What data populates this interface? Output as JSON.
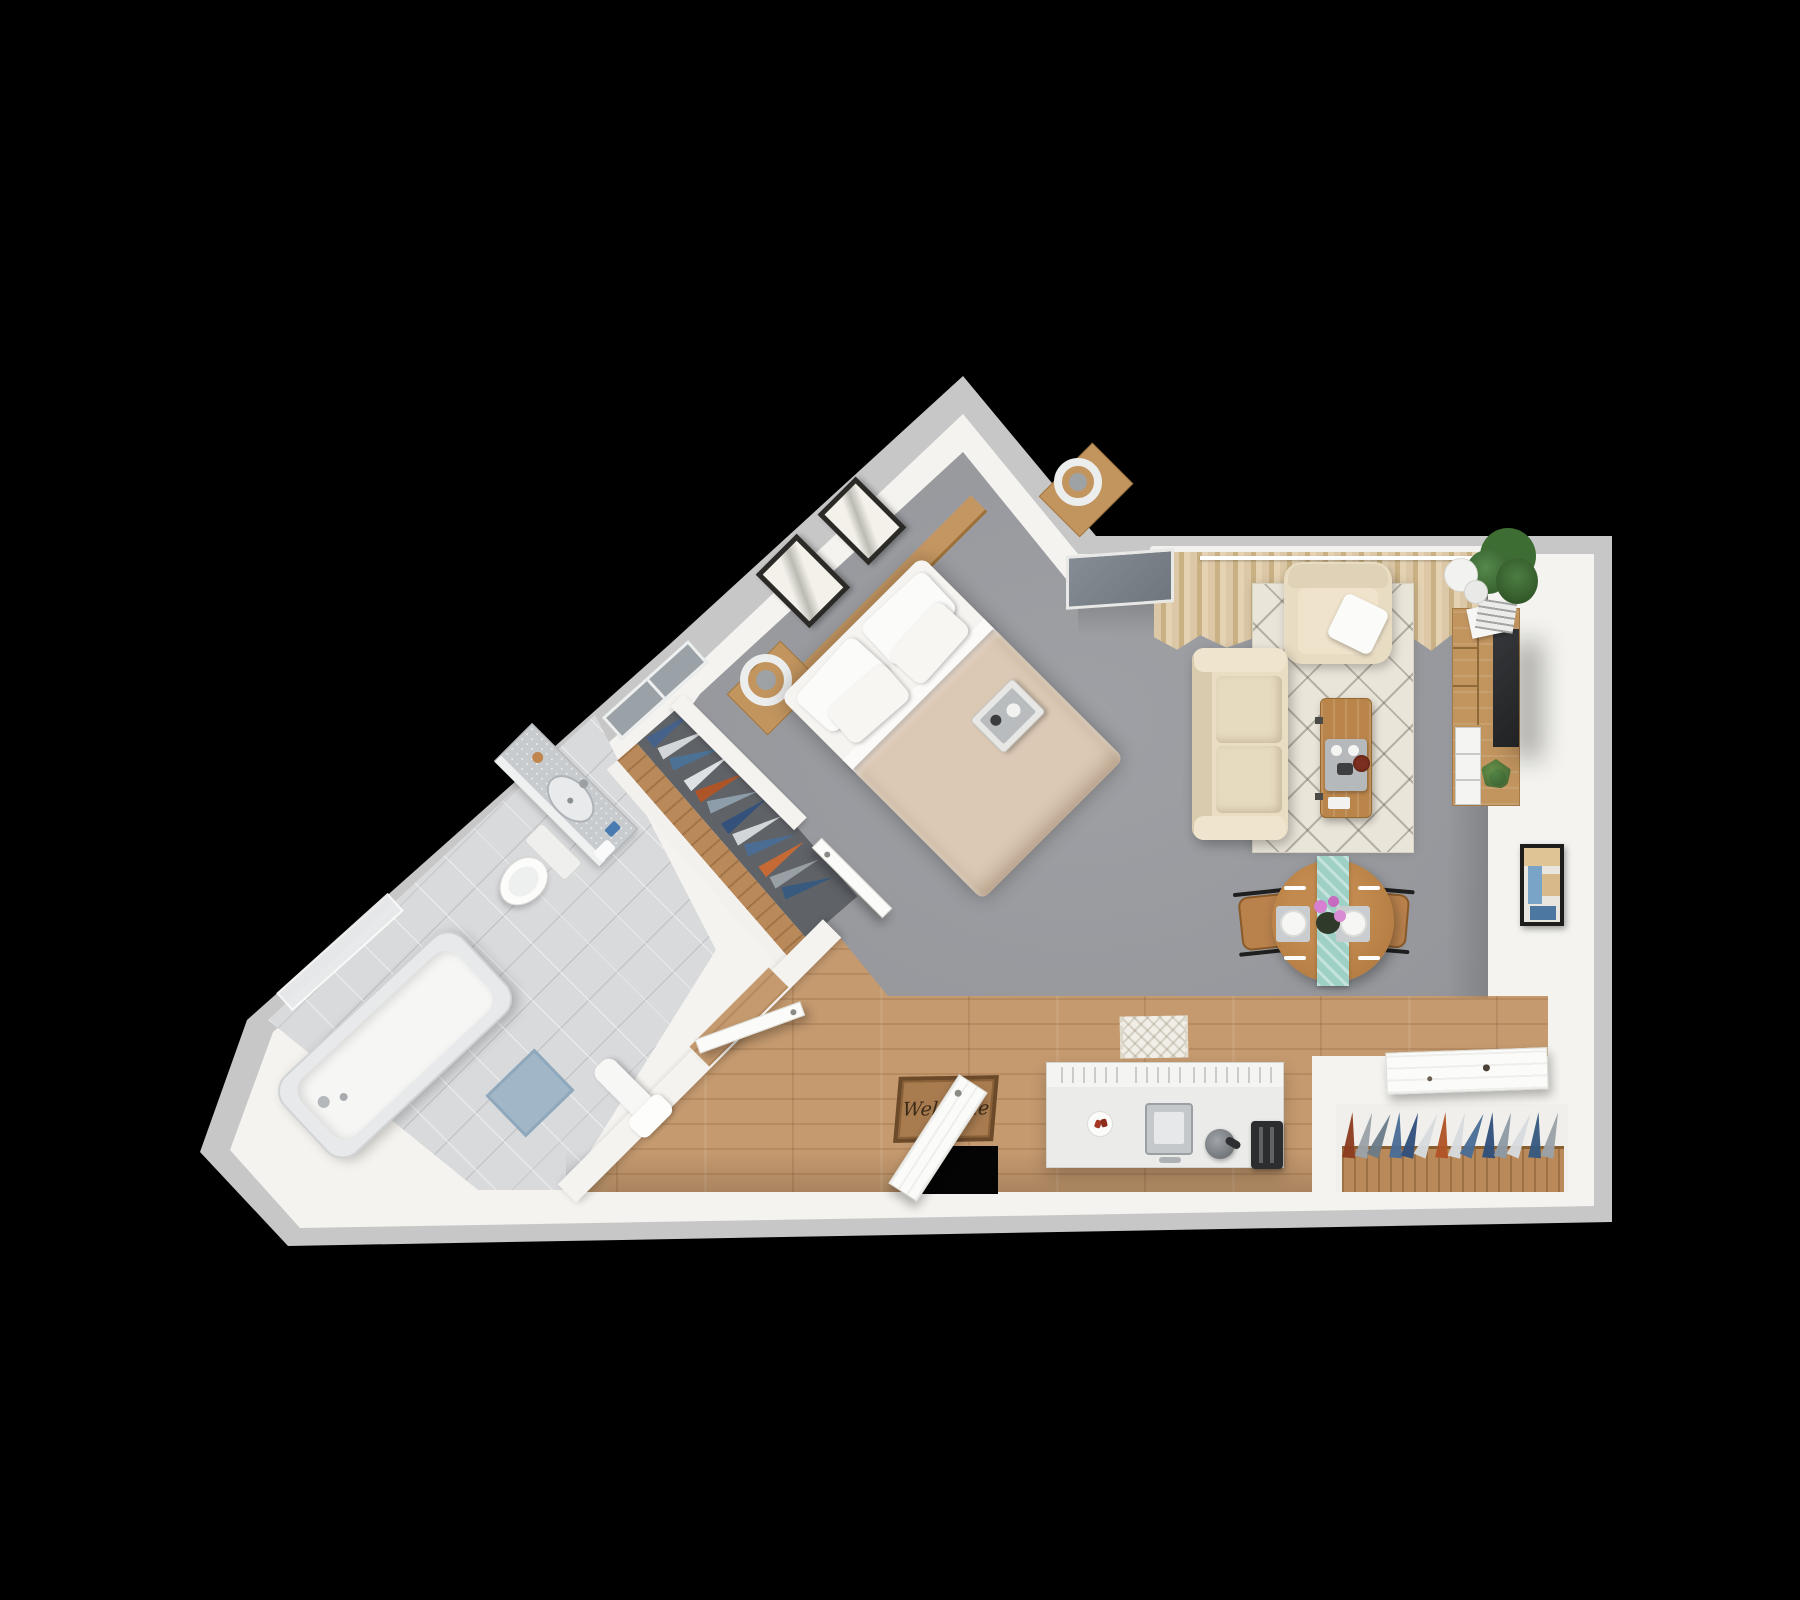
{
  "scene": {
    "description": "3D top-down rendered floor plan of a studio apartment on a black background",
    "width": 1800,
    "height": 1600
  },
  "texts": {
    "doormat": "Welcome"
  },
  "palette": {
    "background": "#000000",
    "wall_outer": "#c7c7c7",
    "wall_inner": "#f4f3ef",
    "carpet": "#96989d",
    "wardrobe_floor_shadow": "#5f6368",
    "wood_floor": "#c59a6f",
    "wood_furniture": "#c2955f",
    "bathroom_tile": "#d9dadc",
    "area_rug_cream": "#eae5d9",
    "sofa_beige": "#e9ddc4",
    "bed_duvet": "#dcc9b5",
    "table_runner_teal": "#9fd0c6",
    "doormat_brown": "#a97c50",
    "plant_green": "#4a7a3d",
    "tv_screen": "#2a2b2d",
    "skylight_gray": "#7f868e",
    "bath_mat_blue": "#9fb6c7",
    "flower_pink": "#d77fd0"
  },
  "rooms": [
    {
      "name": "bedroom"
    },
    {
      "name": "living-room"
    },
    {
      "name": "dining-area"
    },
    {
      "name": "kitchen"
    },
    {
      "name": "bathroom"
    },
    {
      "name": "entry"
    },
    {
      "name": "wardrobe"
    },
    {
      "name": "closet"
    }
  ],
  "wardrobe_clothes": [
    "#46628b",
    "#d7dbde",
    "#4a7296",
    "#e3e6e8",
    "#b05427",
    "#8fa0ad",
    "#31507c",
    "#d7dbde",
    "#4a6d96",
    "#c96a33",
    "#9aa2a8",
    "#35597f"
  ],
  "closet_clothes": [
    "#8e3c1f",
    "#9aa2a8",
    "#6b7c88",
    "#4a6d96",
    "#31507c",
    "#d7dbde",
    "#b05427",
    "#d7dbde",
    "#4a6d96",
    "#31507c",
    "#8e9aa4",
    "#d7dbde",
    "#35597f",
    "#9aa2a8"
  ]
}
